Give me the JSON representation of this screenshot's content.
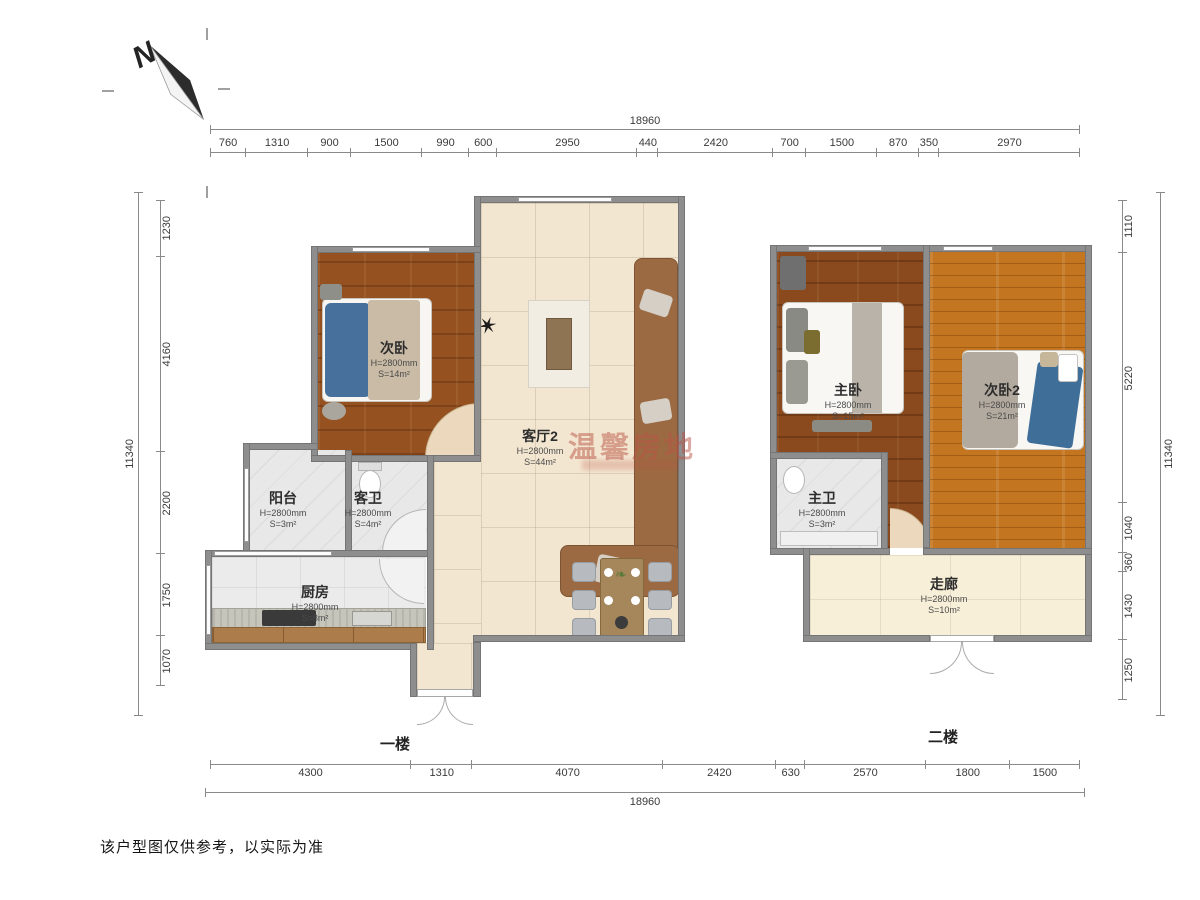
{
  "compass": {
    "label": "N"
  },
  "dimensions": {
    "top": {
      "total": "18960",
      "segments": [
        760,
        1310,
        900,
        1500,
        990,
        600,
        2950,
        440,
        2420,
        700,
        1500,
        870,
        350,
        2970
      ]
    },
    "bottom": {
      "total": "18960",
      "segments": [
        4300,
        1310,
        4070,
        2420,
        630,
        2570,
        1800,
        1500
      ]
    },
    "left": {
      "total": "11340",
      "segments": [
        1230,
        4160,
        2200,
        1750,
        1070
      ]
    },
    "right": {
      "total": "11340",
      "segments": [
        1110,
        5220,
        1040,
        360,
        1430,
        1250
      ]
    }
  },
  "floors": {
    "first": {
      "label": "一楼"
    },
    "second": {
      "label": "二楼"
    }
  },
  "rooms": {
    "cw": {
      "name": "次卧",
      "height": "H=2800mm",
      "area": "S=14m²"
    },
    "kt2": {
      "name": "客厅2",
      "height": "H=2800mm",
      "area": "S=44m²"
    },
    "yt": {
      "name": "阳台",
      "height": "H=2800mm",
      "area": "S=3m²"
    },
    "kw": {
      "name": "客卫",
      "height": "H=2800mm",
      "area": "S=4m²"
    },
    "cf": {
      "name": "厨房",
      "height": "H=2800mm",
      "area": "S=8m²"
    },
    "zw": {
      "name": "主卧",
      "height": "H=2800mm",
      "area": "S=15m²"
    },
    "cw2": {
      "name": "次卧2",
      "height": "H=2800mm",
      "area": "S=21m²"
    },
    "zwei": {
      "name": "主卫",
      "height": "H=2800mm",
      "area": "S=3m²"
    },
    "zl": {
      "name": "走廊",
      "height": "H=2800mm",
      "area": "S=10m²"
    }
  },
  "watermark": {
    "text": "温馨房地"
  },
  "note": "该户型图仅供参考，以实际为准",
  "colors": {
    "wall": "#8e8e8e",
    "watermark": "#ba5446",
    "dimension_line": "#8a8a8a"
  }
}
